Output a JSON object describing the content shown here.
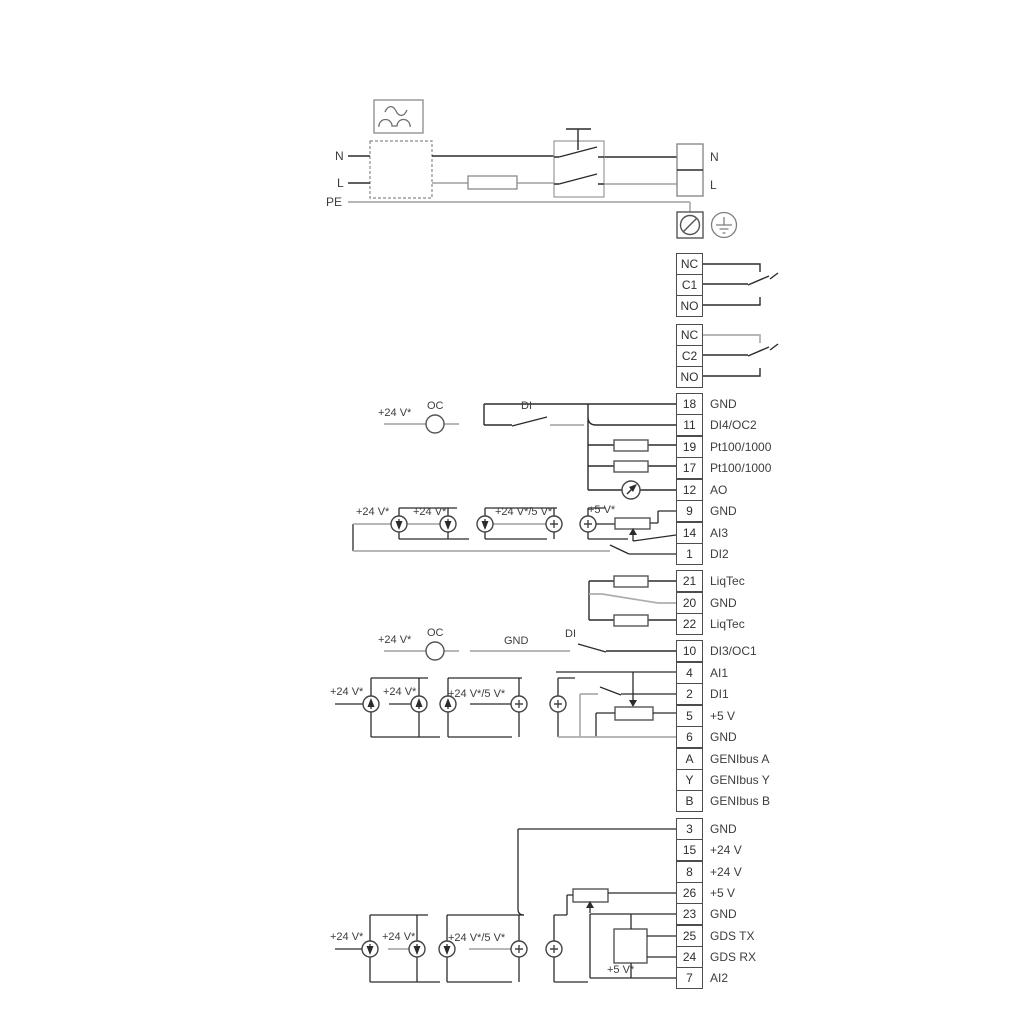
{
  "power": {
    "input_labels": {
      "n": "N",
      "l": "L",
      "pe": "PE"
    },
    "output_labels": {
      "n": "N",
      "l": "L"
    }
  },
  "relay1": {
    "nc": "NC",
    "c": "C1",
    "no": "NO"
  },
  "relay2": {
    "nc": "NC",
    "c": "C2",
    "no": "NO"
  },
  "groups": {
    "io1": [
      {
        "id": "18",
        "label": "GND"
      },
      {
        "id": "11",
        "label": "DI4/OC2"
      },
      {
        "id": "19",
        "label": "Pt100/1000"
      },
      {
        "id": "17",
        "label": "Pt100/1000"
      },
      {
        "id": "12",
        "label": "AO"
      },
      {
        "id": "9",
        "label": "GND"
      },
      {
        "id": "14",
        "label": "AI3"
      },
      {
        "id": "1",
        "label": "DI2"
      }
    ],
    "liqtec": [
      {
        "id": "21",
        "label": "LiqTec"
      },
      {
        "id": "20",
        "label": "GND"
      },
      {
        "id": "22",
        "label": "LiqTec"
      }
    ],
    "io2": [
      {
        "id": "10",
        "label": "DI3/OC1"
      },
      {
        "id": "4",
        "label": "AI1"
      },
      {
        "id": "2",
        "label": "DI1"
      },
      {
        "id": "5",
        "label": "+5 V"
      },
      {
        "id": "6",
        "label": "GND"
      },
      {
        "id": "A",
        "label": "GENIbus A"
      },
      {
        "id": "Y",
        "label": "GENIbus Y"
      },
      {
        "id": "B",
        "label": "GENIbus B"
      }
    ],
    "io3": [
      {
        "id": "3",
        "label": "GND"
      },
      {
        "id": "15",
        "label": "+24 V"
      },
      {
        "id": "8",
        "label": "+24 V"
      },
      {
        "id": "26",
        "label": "+5 V"
      },
      {
        "id": "23",
        "label": "GND"
      },
      {
        "id": "25",
        "label": "GDS TX"
      },
      {
        "id": "24",
        "label": "GDS RX"
      },
      {
        "id": "7",
        "label": "AI2"
      }
    ]
  },
  "annotations": {
    "di4_row": {
      "supply": "+24 V*",
      "oc": "OC",
      "di": "DI"
    },
    "ai3_row": {
      "s1": "+24 V*",
      "s2": "+24 V*",
      "s3": "+24 V*/5 V*",
      "s4": "+5 V*"
    },
    "di3_row": {
      "supply": "+24 V*",
      "oc": "OC",
      "gnd": "GND",
      "di": "DI"
    },
    "ai1_row": {
      "s1": "+24 V*",
      "s2": "+24 V*",
      "s3": "+24 V*/5 V*"
    },
    "ai2_row": {
      "s1": "+24 V*",
      "s2": "+24 V*",
      "s3": "+24 V*/5 V*",
      "s4": "+5 V*"
    }
  },
  "colors": {
    "wire": "#2b2b2b",
    "wire_gray": "#adadad",
    "text": "#3d3d3d"
  }
}
